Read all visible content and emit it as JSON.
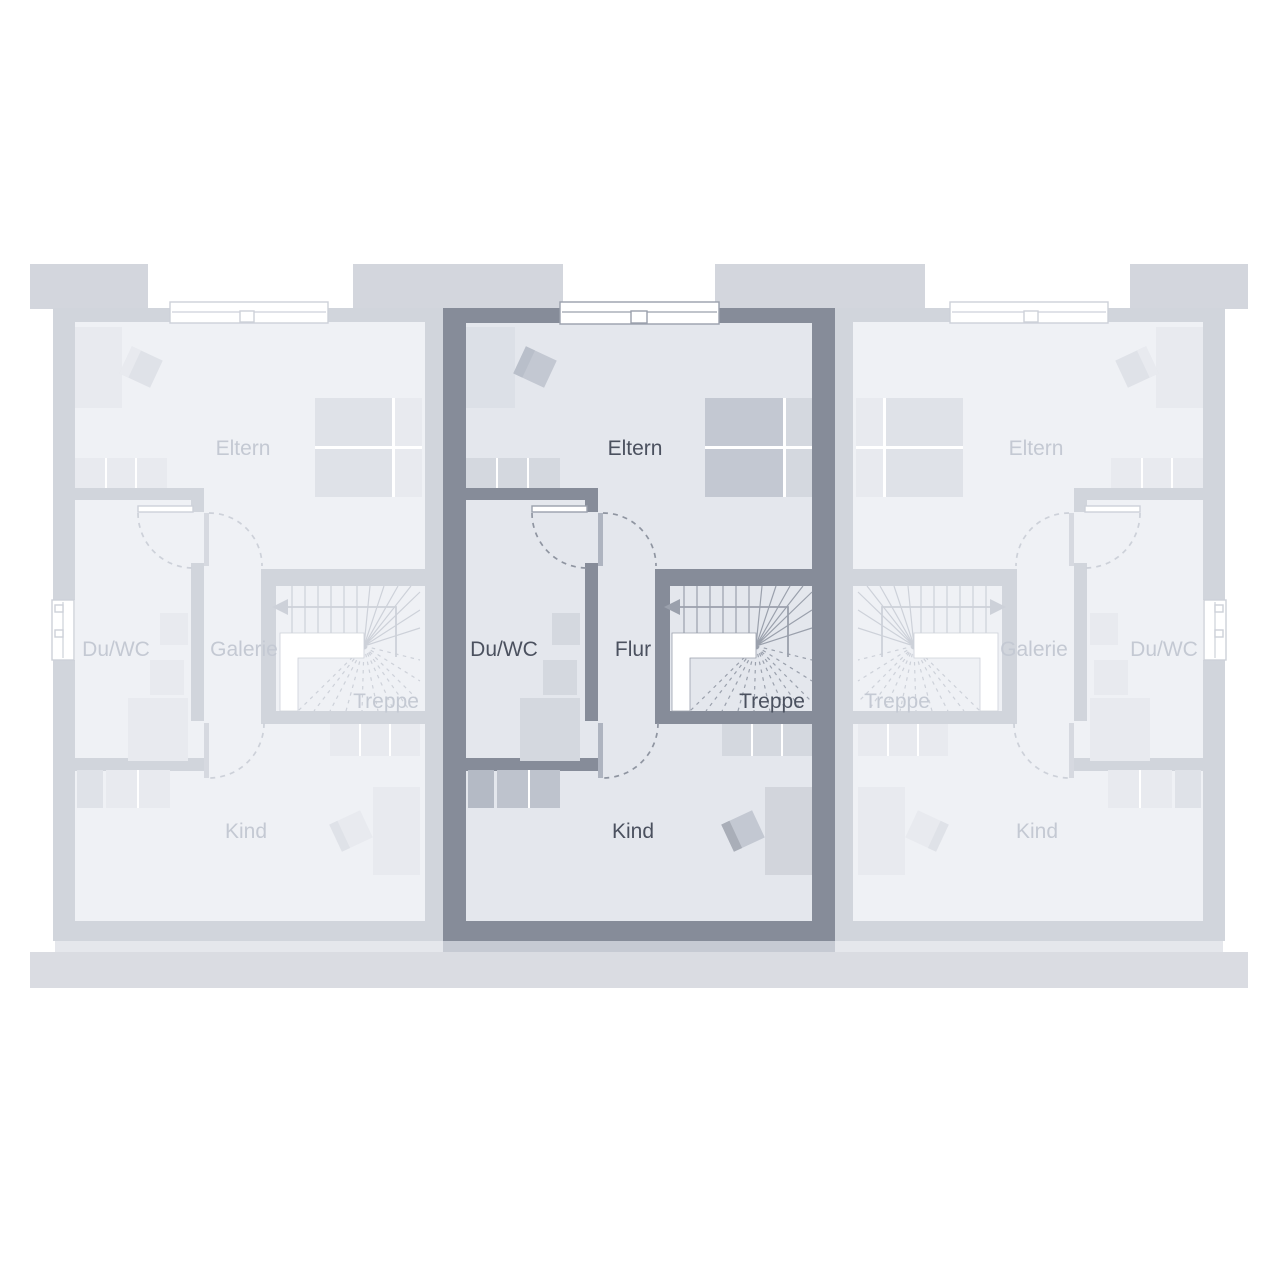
{
  "floorplan": {
    "description": "Obergeschoss-Grundriss dreier Reihenhaeuser, mittlere Einheit hervorgehoben",
    "units": [
      {
        "id": "left",
        "state": "inactive",
        "rooms": {
          "bedroom": "Eltern",
          "bath": "Du/WC",
          "hall": "Galerie",
          "stairs": "Treppe",
          "child": "Kind"
        }
      },
      {
        "id": "middle",
        "state": "active",
        "rooms": {
          "bedroom": "Eltern",
          "bath": "Du/WC",
          "hall": "Flur",
          "stairs": "Treppe",
          "child": "Kind"
        }
      },
      {
        "id": "right",
        "state": "inactive",
        "rooms": {
          "bedroom": "Eltern",
          "bath": "Du/WC",
          "hall": "Galerie",
          "stairs": "Treppe",
          "child": "Kind"
        }
      }
    ],
    "colors": {
      "background": "#ffffff",
      "active_wall": "#868c99",
      "active_floor": "#e4e7ed",
      "active_line": "#9aa0ac",
      "active_text": "#4b515f",
      "active_furniture_dark": "#c3c8d2",
      "active_furniture_light": "#d4d8df",
      "active_closet": "#dce0e7",
      "inactive_wall": "#d1d5dc",
      "inactive_floor": "#eff1f5",
      "inactive_line": "#cdd1d9",
      "inactive_text": "#c4c9d3",
      "inactive_furniture_dark": "#dfe2e8",
      "inactive_furniture_light": "#e8eaef",
      "dormer": "#d3d6dd",
      "terrace": "#dadce2",
      "active_apron": "#c6cad3",
      "inactive_apron": "#e5e7ec"
    }
  }
}
